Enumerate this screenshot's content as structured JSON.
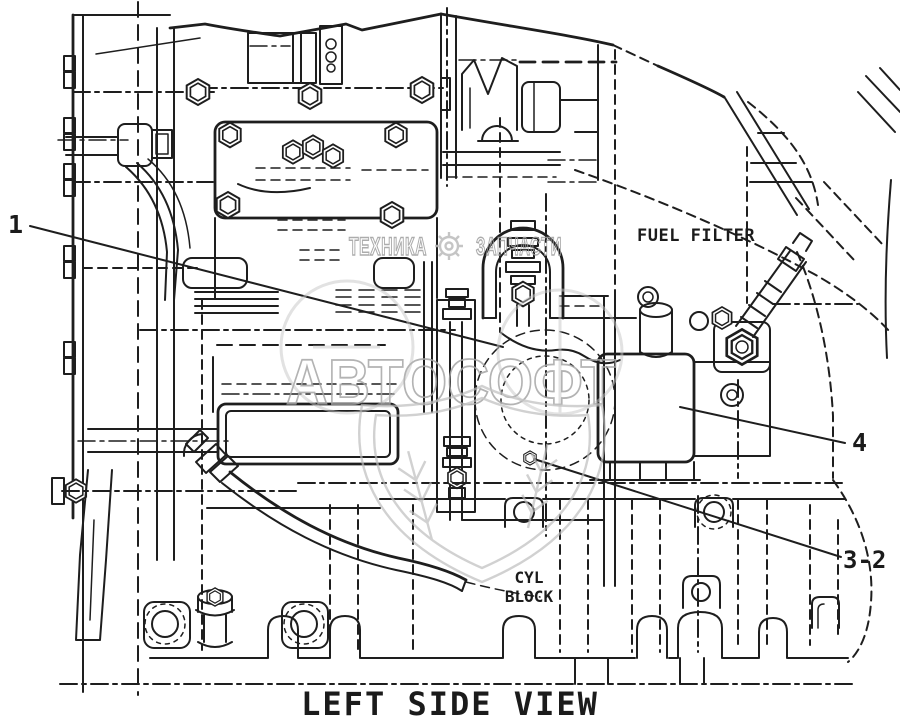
{
  "page": {
    "background_color": "#ffffff",
    "line_color": "#1e1e1e",
    "watermark_color": "#b2b2b2"
  },
  "diagram": {
    "view_title": "LEFT SIDE VIEW",
    "labels": {
      "fuel_filter": "FUEL FILTER",
      "cyl_block_line1": "CYL",
      "cyl_block_line2": "BLOCK"
    },
    "callouts": {
      "c1": "1",
      "c4": "4",
      "c3_2": "3-2"
    }
  },
  "watermark": {
    "left_text": "ТЕХНИКА",
    "right_text": "ЗАПЧАСТИ",
    "brand_text": "АВТОСОФТ"
  }
}
